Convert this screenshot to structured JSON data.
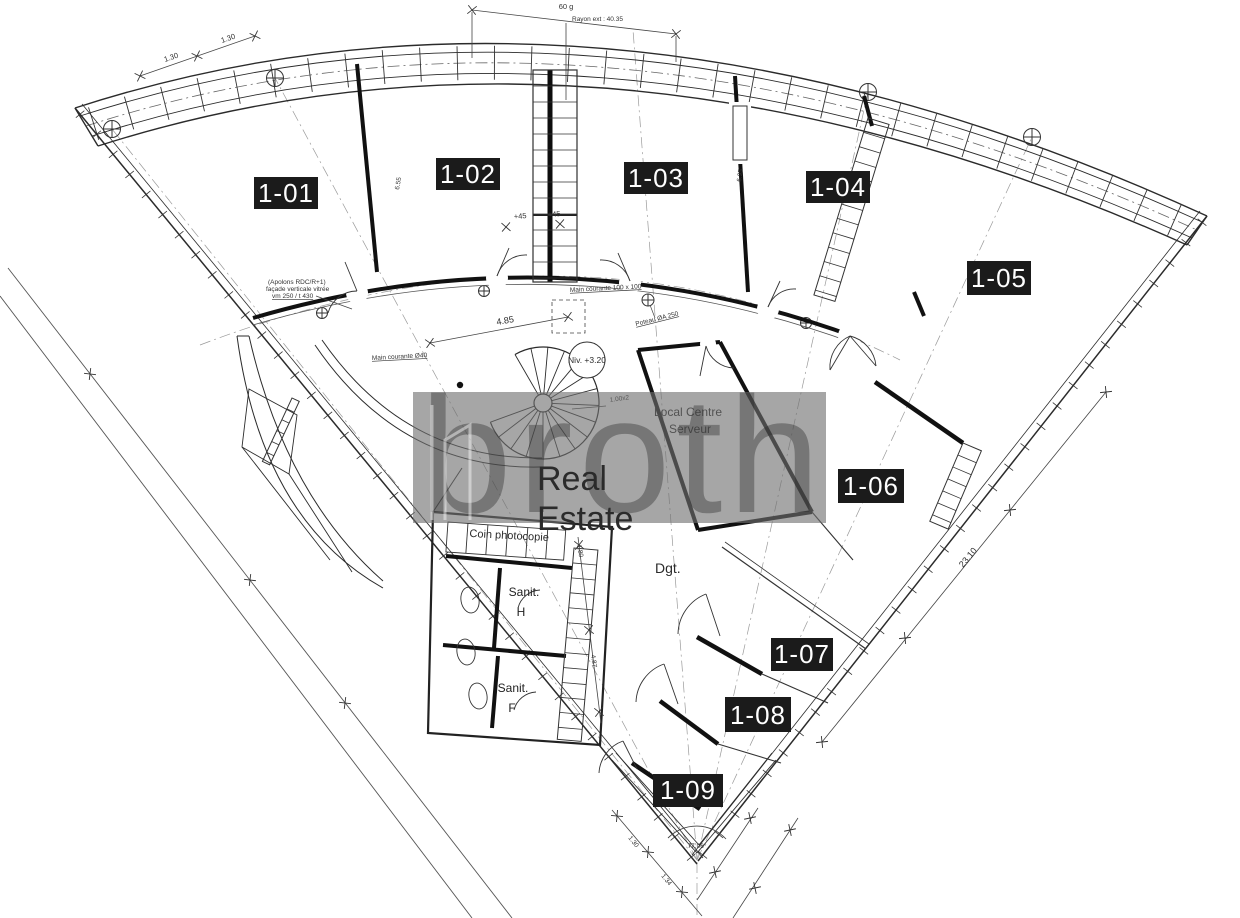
{
  "rooms": [
    {
      "label": "1-01"
    },
    {
      "label": "1-02"
    },
    {
      "label": "1-03"
    },
    {
      "label": "1-04"
    },
    {
      "label": "1-05"
    },
    {
      "label": "1-06"
    },
    {
      "label": "1-07"
    },
    {
      "label": "1-08"
    },
    {
      "label": "1-09"
    }
  ],
  "places": {
    "local_server_1": "Local Centre",
    "local_server_2": "Serveur",
    "corridor": "Dgt.",
    "copy_corner": "Coin photocopie",
    "sanitary_m_1": "Sanit.",
    "sanitary_m_2": "H",
    "sanitary_f_1": "Sanit.",
    "sanitary_f_2": "F",
    "level_mark": "Niv. +3.20"
  },
  "dimensions": {
    "top_angle": "60 g",
    "outer_radius": "Rayon ext : 40.35",
    "d130a": "1.30",
    "d130b": "1.30",
    "d485": "4.85",
    "d655": "6.55",
    "d695": "6.95",
    "p45a": "+45",
    "p45b": "+45",
    "d100x2": "1.00x2",
    "d2310": "23.10",
    "apex_angle": "77.06°",
    "d130c": "1.30",
    "d134": "1.34",
    "d487": "4.87",
    "d180": "1.80"
  },
  "notes": {
    "handrail": "Main courante Ø40",
    "handrail2": "Main courante 100 x 100",
    "column": "Poteau ØA 250",
    "facade_1": "(Apolons RDC/R+1)",
    "facade_2": "façade verticale vitrée",
    "facade_3": "vm 250 / t 430"
  },
  "watermark": {
    "brand": "brother",
    "label_1": "Real",
    "label_2": "Estate",
    "accent_color": "#e8666b"
  }
}
